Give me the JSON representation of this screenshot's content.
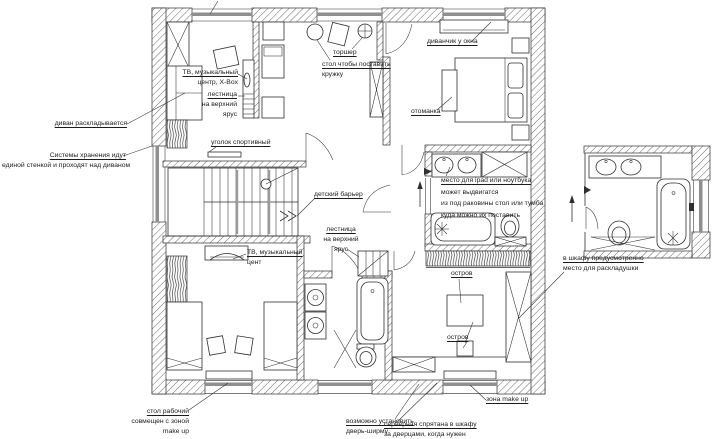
{
  "document": {
    "kind": "interior floor plan",
    "language": "ru"
  },
  "colors": {
    "ink": "#2f2f2f",
    "wall_hatch": "#6a6a6a",
    "window_bar": "#8f8f8f",
    "rail_gray": "#9a9a9a",
    "paper": "#ffffff"
  },
  "annotations": {
    "sofa_folds_out": {
      "lines": [
        "диван раскладывается"
      ]
    },
    "storage_systems": {
      "lines": [
        "Системы хранения идут",
        "единой стенкой и проходят над диваном"
      ]
    },
    "tv_music_center_xbox": {
      "lines": [
        "ТВ, музыкальный",
        "центр, X-Box"
      ]
    },
    "stairs_upper_tier_left": {
      "lines": [
        "лестница",
        "на верхний",
        "ярус"
      ]
    },
    "sport_corner": {
      "lines": [
        "уголок спортивный"
      ]
    },
    "floor_lamp": {
      "lines": [
        "торшер"
      ]
    },
    "mug_table": {
      "lines": [
        "стол чтобы поставить",
        "кружку"
      ]
    },
    "window_sofa": {
      "lines": [
        "диванчик у окна"
      ]
    },
    "ottoman": {
      "lines": [
        "отоманка"
      ]
    },
    "child_barrier": {
      "lines": [
        "детский барьер"
      ]
    },
    "stairs_upper_tier_right": {
      "lines": [
        "лестница",
        "на верхний",
        "ярус"
      ]
    },
    "tv_music_center": {
      "lines": [
        "ТВ, музыкальный",
        "цент"
      ]
    },
    "ipad_place": {
      "lines": [
        "место для ipad или ноутбука",
        "может выдвигатся",
        "из под раковины стол или тумба",
        "куда можно их поставить"
      ]
    },
    "island_top": {
      "lines": [
        "остров"
      ]
    },
    "island_bottom": {
      "lines": [
        "остров"
      ]
    },
    "folding_bed_closet": {
      "lines": [
        "в шкафу предусмотренно",
        "место для раскладушки"
      ]
    },
    "work_desk": {
      "lines": [
        "стол рабочий",
        "совмещен с зоной",
        "make up"
      ]
    },
    "screen_door": {
      "lines": [
        "возможно установить",
        "дверь-ширму"
      ]
    },
    "server_closet": {
      "lines": [
        "серверная спрятана в шкафу",
        "за дверцами, когда нужен"
      ]
    },
    "makeup_zone": {
      "lines": [
        "зона make up"
      ]
    }
  }
}
